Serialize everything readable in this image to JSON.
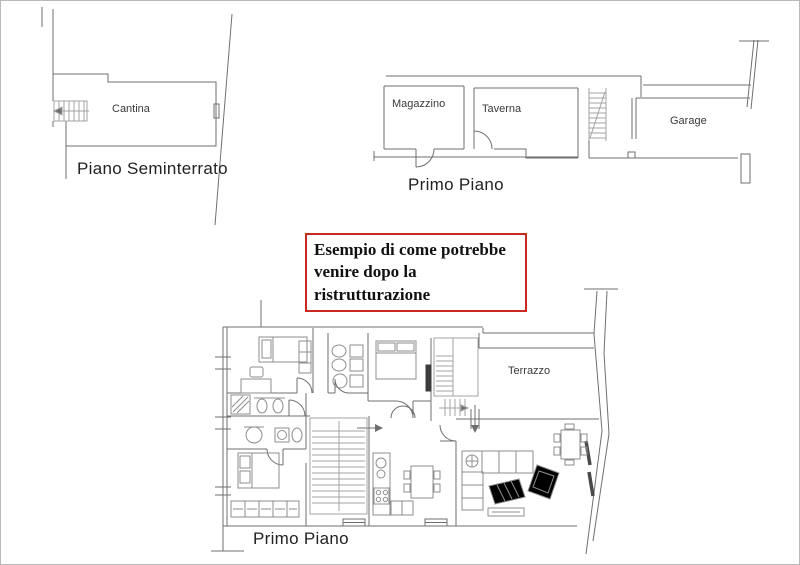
{
  "canvas": {
    "background": "#ffffff",
    "border_color": "#b9b9b9"
  },
  "colors": {
    "wall_line": "#6f6f6f",
    "furniture_line": "#8e8e8e",
    "stairs_line": "#a3a3a3",
    "annotation_border": "#c9291e",
    "annotation_text": "#101010",
    "room_label": "#3a3a3a",
    "plan_title": "#222222"
  },
  "annotation_box": {
    "text": "Esempio di come potrebbe venire dopo la ristrutturazione"
  },
  "plans": {
    "basement": {
      "title": "Piano Seminterrato",
      "rooms": [
        {
          "label": "Cantina"
        }
      ]
    },
    "first_floor": {
      "title": "Primo Piano",
      "rooms": [
        {
          "label": "Magazzino"
        },
        {
          "label": "Taverna"
        },
        {
          "label": "Garage"
        }
      ]
    },
    "renovated_first_floor": {
      "title": "Primo Piano",
      "rooms": [
        {
          "label": "Terrazzo"
        }
      ]
    }
  }
}
